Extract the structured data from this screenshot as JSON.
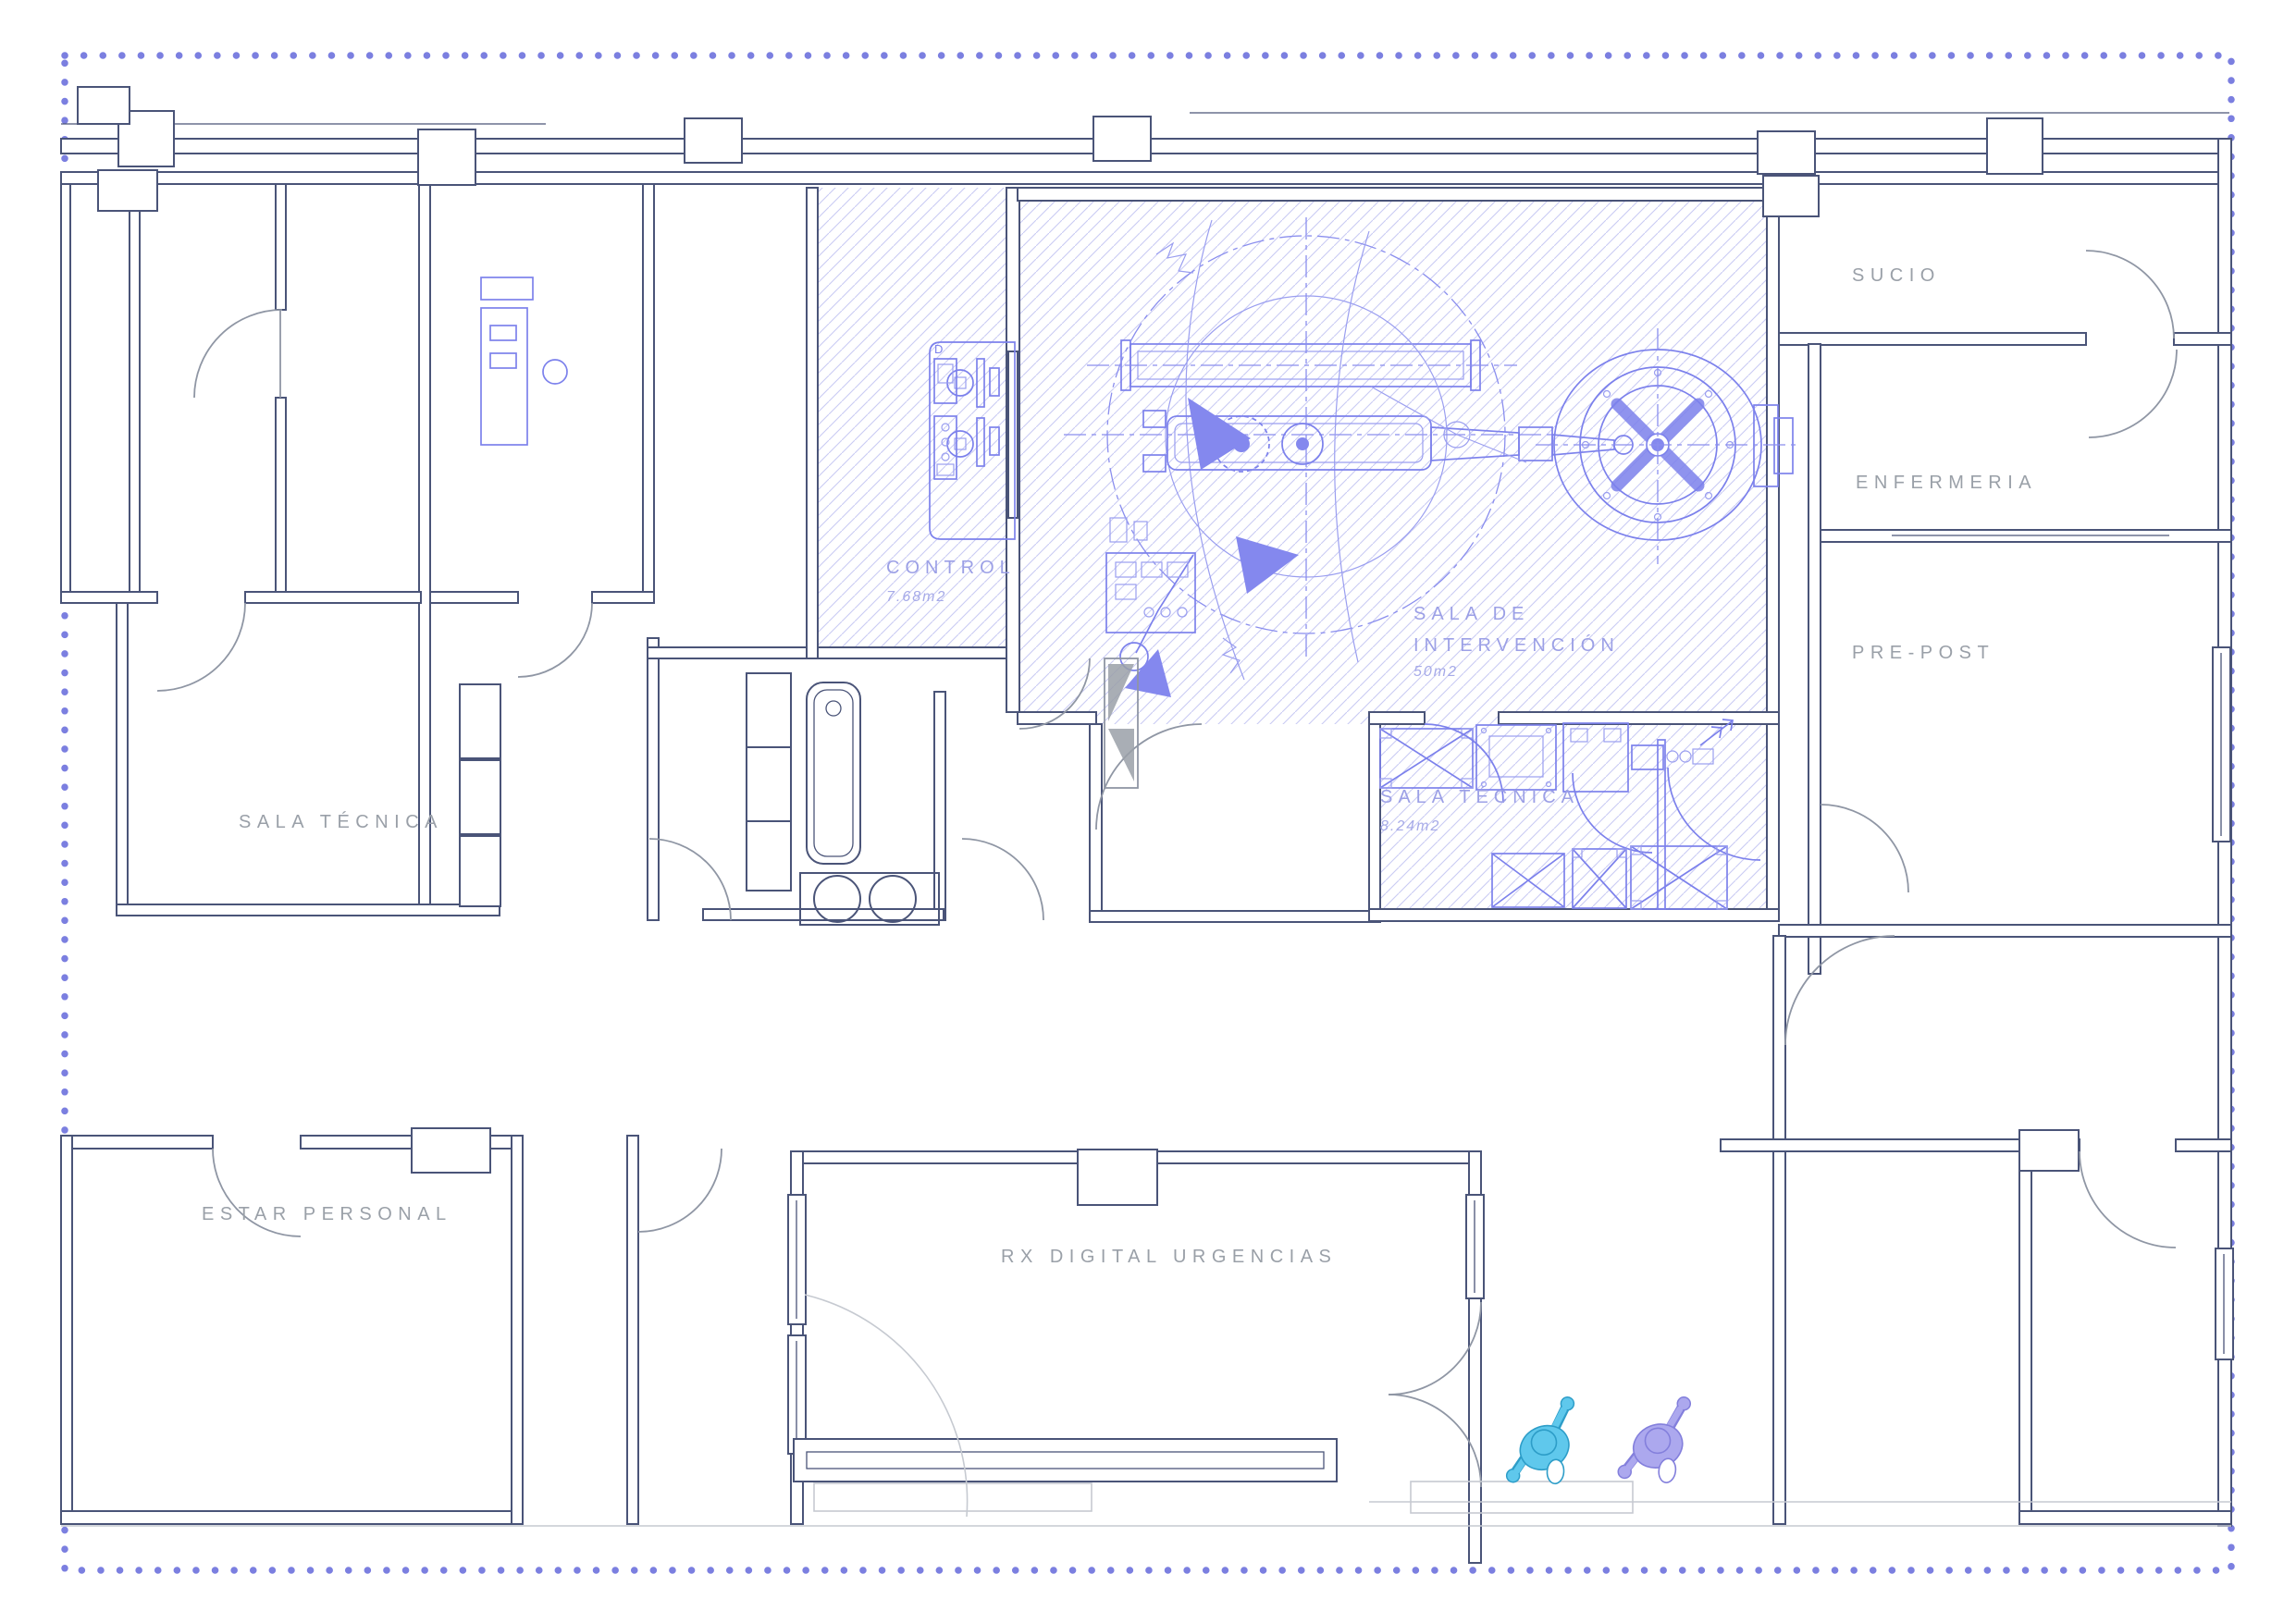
{
  "rooms": {
    "control": {
      "label": "CONTROL",
      "area": "7.68m2"
    },
    "intervencion": {
      "label": "SALA DE INTERVENCIÓN",
      "lines": [
        "SALA DE",
        "INTERVENCIÓN"
      ],
      "area": "50m2"
    },
    "sala_tecnica_equip": {
      "label": "SALA TÉCNICA",
      "area": "8.24m2"
    },
    "sala_tecnica_left": {
      "label": "SALA TÉCNICA"
    },
    "sucio": {
      "label": "SUCIO"
    },
    "enfermeria": {
      "label": "ENFERMERIA"
    },
    "pre_post": {
      "label": "PRE-POST"
    },
    "estar_personal": {
      "label": "ESTAR PERSONAL"
    },
    "rx_digital": {
      "label": "RX DIGITAL URGENCIAS"
    }
  },
  "equipment": {
    "control_rack_tag": "D"
  },
  "people": [
    {
      "id": "person-cyan",
      "color": "#5FC8EC",
      "outline": "#2D9DC8"
    },
    {
      "id": "person-purple",
      "color": "#ACA8EE",
      "outline": "#837FDC"
    }
  ],
  "colors": {
    "border_dots": "#7B7FE0",
    "walls_navy": "#4A5478",
    "walls_gray": "#8F96A4",
    "hatch": "#C9CBF3",
    "equipment_blue": "#7C81EC",
    "beam_purple": "#8488EE",
    "label_gray": "#9AA0A8",
    "label_purple": "#9CA0E6"
  }
}
